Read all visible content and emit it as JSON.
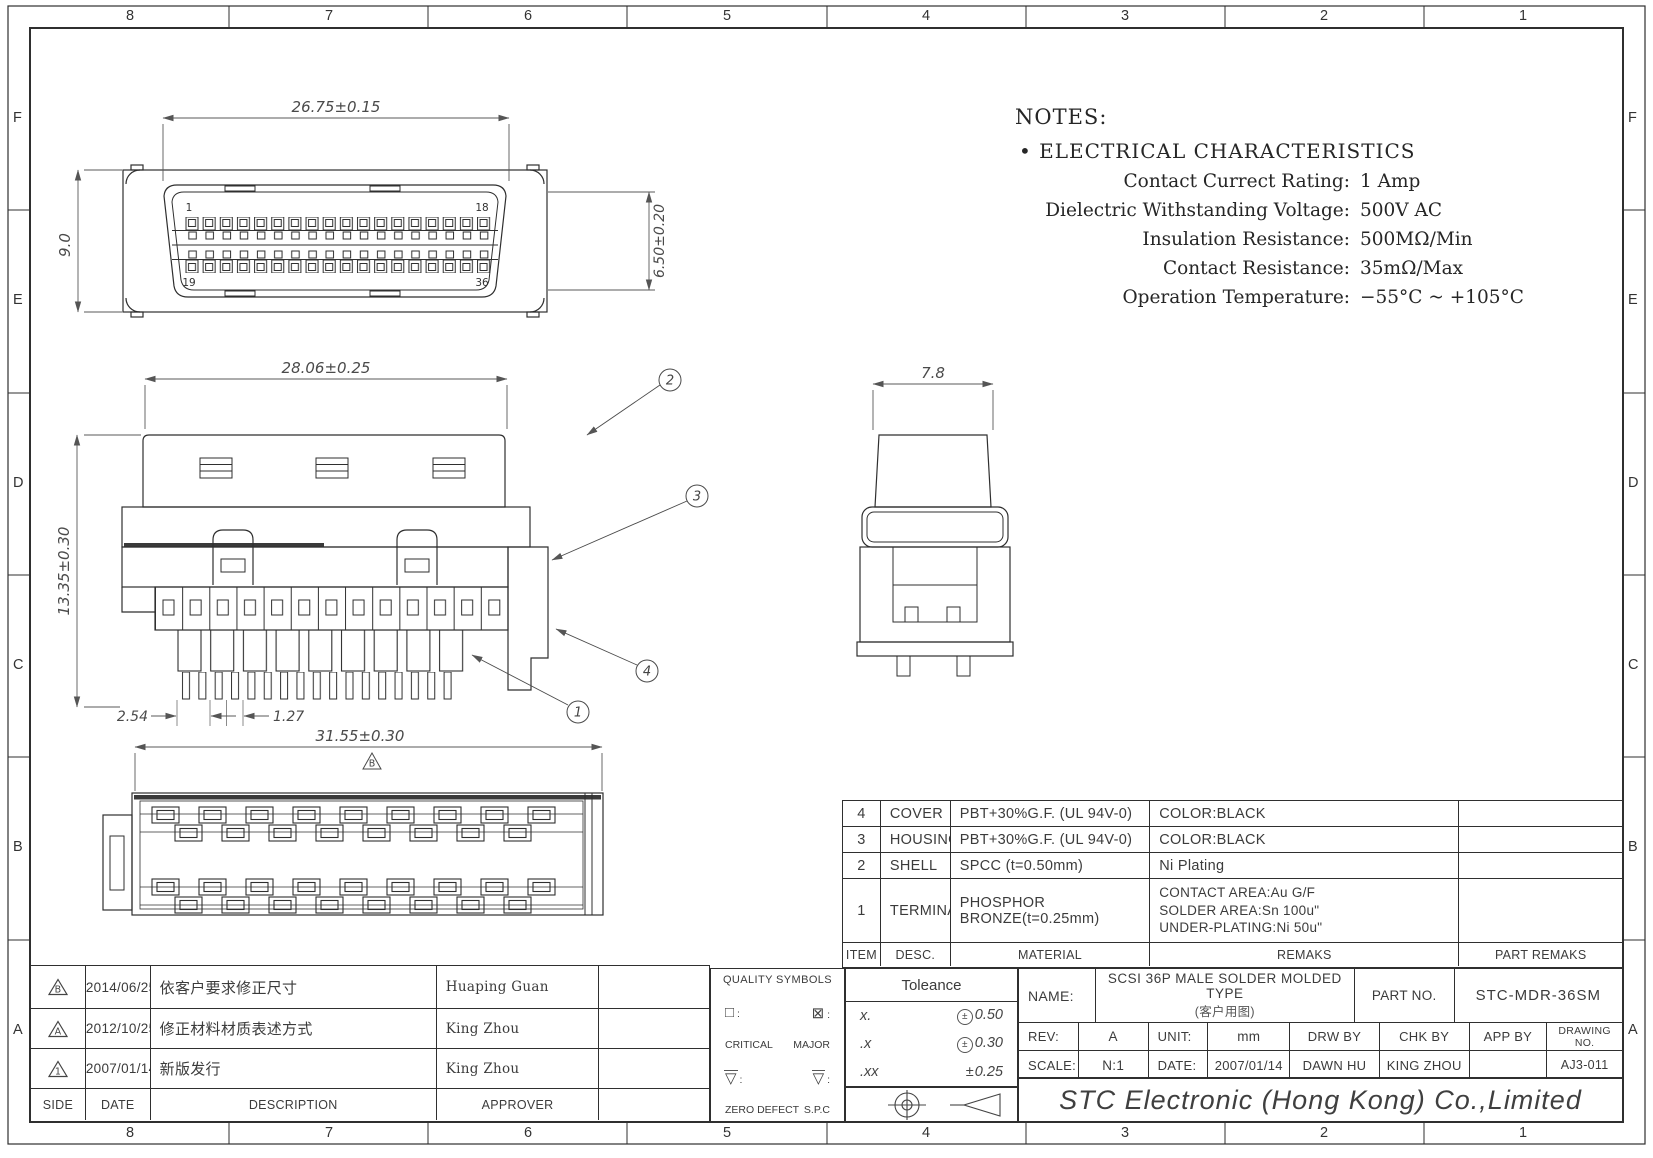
{
  "zones": {
    "cols": [
      "8",
      "7",
      "6",
      "5",
      "4",
      "3",
      "2",
      "1"
    ],
    "rows": [
      "F",
      "E",
      "D",
      "C",
      "B",
      "A"
    ]
  },
  "notes": {
    "title": "NOTES:",
    "bullet": "•",
    "heading": "ELECTRICAL CHARACTERISTICS",
    "items": [
      {
        "label": "Contact Currect Rating:",
        "value": "1 Amp"
      },
      {
        "label": "Dielectric Withstanding Voltage:",
        "value": "500V AC"
      },
      {
        "label": "Insulation Resistance:",
        "value": "500MΩ/Min"
      },
      {
        "label": "Contact Resistance:",
        "value": "35mΩ/Max"
      },
      {
        "label": "Operation Temperature:",
        "value": "−55°C ~ +105°C"
      }
    ]
  },
  "views": {
    "front": {
      "dim_width": "26.75±0.15",
      "dim_height": "9.0",
      "dim_opening": "6.50±0.20",
      "pin_top_left": "1",
      "pin_top_right": "18",
      "pin_bottom_left": "19",
      "pin_bottom_right": "36"
    },
    "side": {
      "dim_width": "28.06±0.25",
      "dim_height": "13.35±0.30",
      "dim_pitch": "2.54",
      "dim_half_pitch": "1.27",
      "callout_cover": "2",
      "callout_housing": "3",
      "callout_shell": "4",
      "callout_terminal": "1"
    },
    "end": {
      "dim_width": "7.8"
    },
    "bottom": {
      "dim_width": "31.55±0.30",
      "rev_mark": "B"
    }
  },
  "bom": {
    "headers": {
      "item": "ITEM",
      "desc": "DESC.",
      "material": "MATERIAL",
      "remaks": "REMAKS",
      "part_remaks": "PART REMAKS"
    },
    "rows": [
      {
        "item": "4",
        "desc": "COVER",
        "material": "PBT+30%G.F. (UL 94V-0)",
        "remaks": "COLOR:BLACK"
      },
      {
        "item": "3",
        "desc": "HOUSING",
        "material": "PBT+30%G.F. (UL 94V-0)",
        "remaks": "COLOR:BLACK"
      },
      {
        "item": "2",
        "desc": "SHELL",
        "material": "SPCC (t=0.50mm)",
        "remaks": "Ni Plating"
      },
      {
        "item": "1",
        "desc": "TERMINAL",
        "material": "PHOSPHOR BRONZE(t=0.25mm)",
        "remaks_line1": "CONTACT AREA:Au G/F",
        "remaks_line2": "SOLDER AREA:Sn 100u\"",
        "remaks_line3": "UNDER-PLATING:Ni 50u\""
      }
    ]
  },
  "revisions": {
    "headers": {
      "side": "SIDE",
      "date": "DATE",
      "description": "DESCRIPTION",
      "approver": "APPROVER"
    },
    "rows": [
      {
        "mark": "B",
        "date": "2014/06/25",
        "description": "依客户要求修正尺寸",
        "approver": "Huaping Guan"
      },
      {
        "mark": "A",
        "date": "2012/10/25",
        "description": "修正材料材质表述方式",
        "approver": "King Zhou"
      },
      {
        "mark": "1",
        "date": "2007/01/14",
        "description": "新版发行",
        "approver": "King Zhou"
      }
    ]
  },
  "quality": {
    "title": "QUALITY SYMBOLS",
    "sym_critical": "□",
    "sym_major": "⊠",
    "colon": ":",
    "label_critical": "CRITICAL",
    "label_major": "MAJOR",
    "tri": "▽",
    "label_zero_defect": "ZERO DEFECT",
    "label_spc": "S.P.C"
  },
  "tolerance": {
    "title": "Toleance",
    "rows": [
      {
        "places": "x.",
        "sign": "±",
        "value": "0.50"
      },
      {
        "places": ".x",
        "sign": "±",
        "value": "0.30"
      },
      {
        "places": ".xx",
        "sign": "±",
        "value": "0.25"
      }
    ]
  },
  "titleblock": {
    "name_label": "NAME:",
    "name_line1": "SCSI 36P MALE SOLDER MOLDED TYPE",
    "name_line2": "(客户用图)",
    "part_no_label": "PART NO.",
    "part_no": "STC-MDR-36SM",
    "rev_label": "REV:",
    "rev": "A",
    "unit_label": "UNIT:",
    "unit": "mm",
    "drw_by_label": "DRW BY",
    "drw_by": "DAWN HU",
    "chk_by_label": "CHK BY",
    "chk_by": "KING ZHOU",
    "app_by_label": "APP BY",
    "app_by": "",
    "drawing_no_label": "DRAWING NO.",
    "drawing_no": "AJ3-011",
    "scale_label": "SCALE:",
    "scale": "N:1",
    "date_label": "DATE:",
    "date": "2007/01/14",
    "company": "STC Electronic (Hong Kong) Co.,Limited"
  }
}
